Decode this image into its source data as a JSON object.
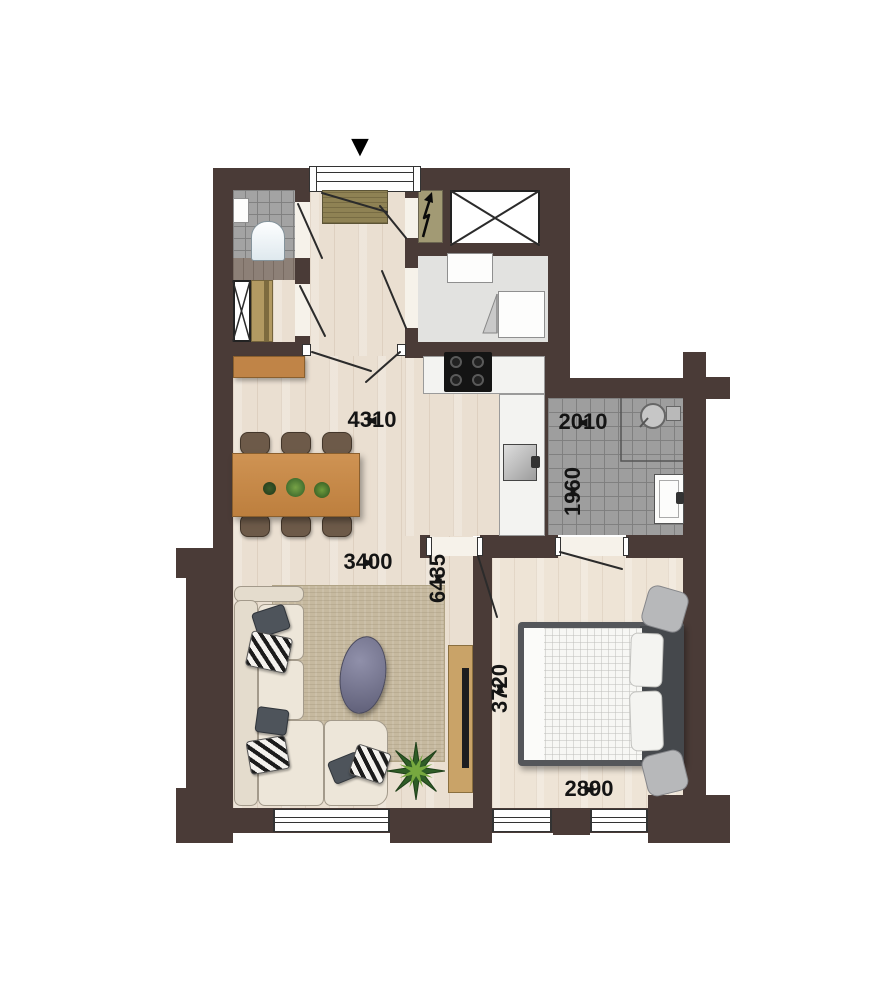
{
  "floorplan": {
    "entrance_marker": "▼",
    "symbols": {
      "left": "◄",
      "right": "►",
      "up": "▲",
      "down": "▼"
    },
    "dimensions": {
      "hall_width": "4310",
      "living_width": "3400",
      "living_length": "6435",
      "bathroom_width": "2010",
      "bathroom_length": "1960",
      "bedroom_length": "3720",
      "bedroom_width": "2890"
    },
    "colors": {
      "wall": "#4a3b37",
      "wood_floor": "#eadfd1",
      "bedroom_floor": "#eee4d6",
      "tile_floor": "#9e9e9e",
      "utility_floor": "#e2e2e0",
      "counter": "#f3f3f1",
      "cabinet_wood": "#c08447",
      "table_wood": "#c68a4b",
      "doormat": "#8f8254",
      "tech_closet": "#a29a74",
      "sofa": "#ede6d9",
      "rug": "#c6b99f",
      "bed_frame": "#54565a",
      "coffee_table": "#6e6e87"
    }
  }
}
